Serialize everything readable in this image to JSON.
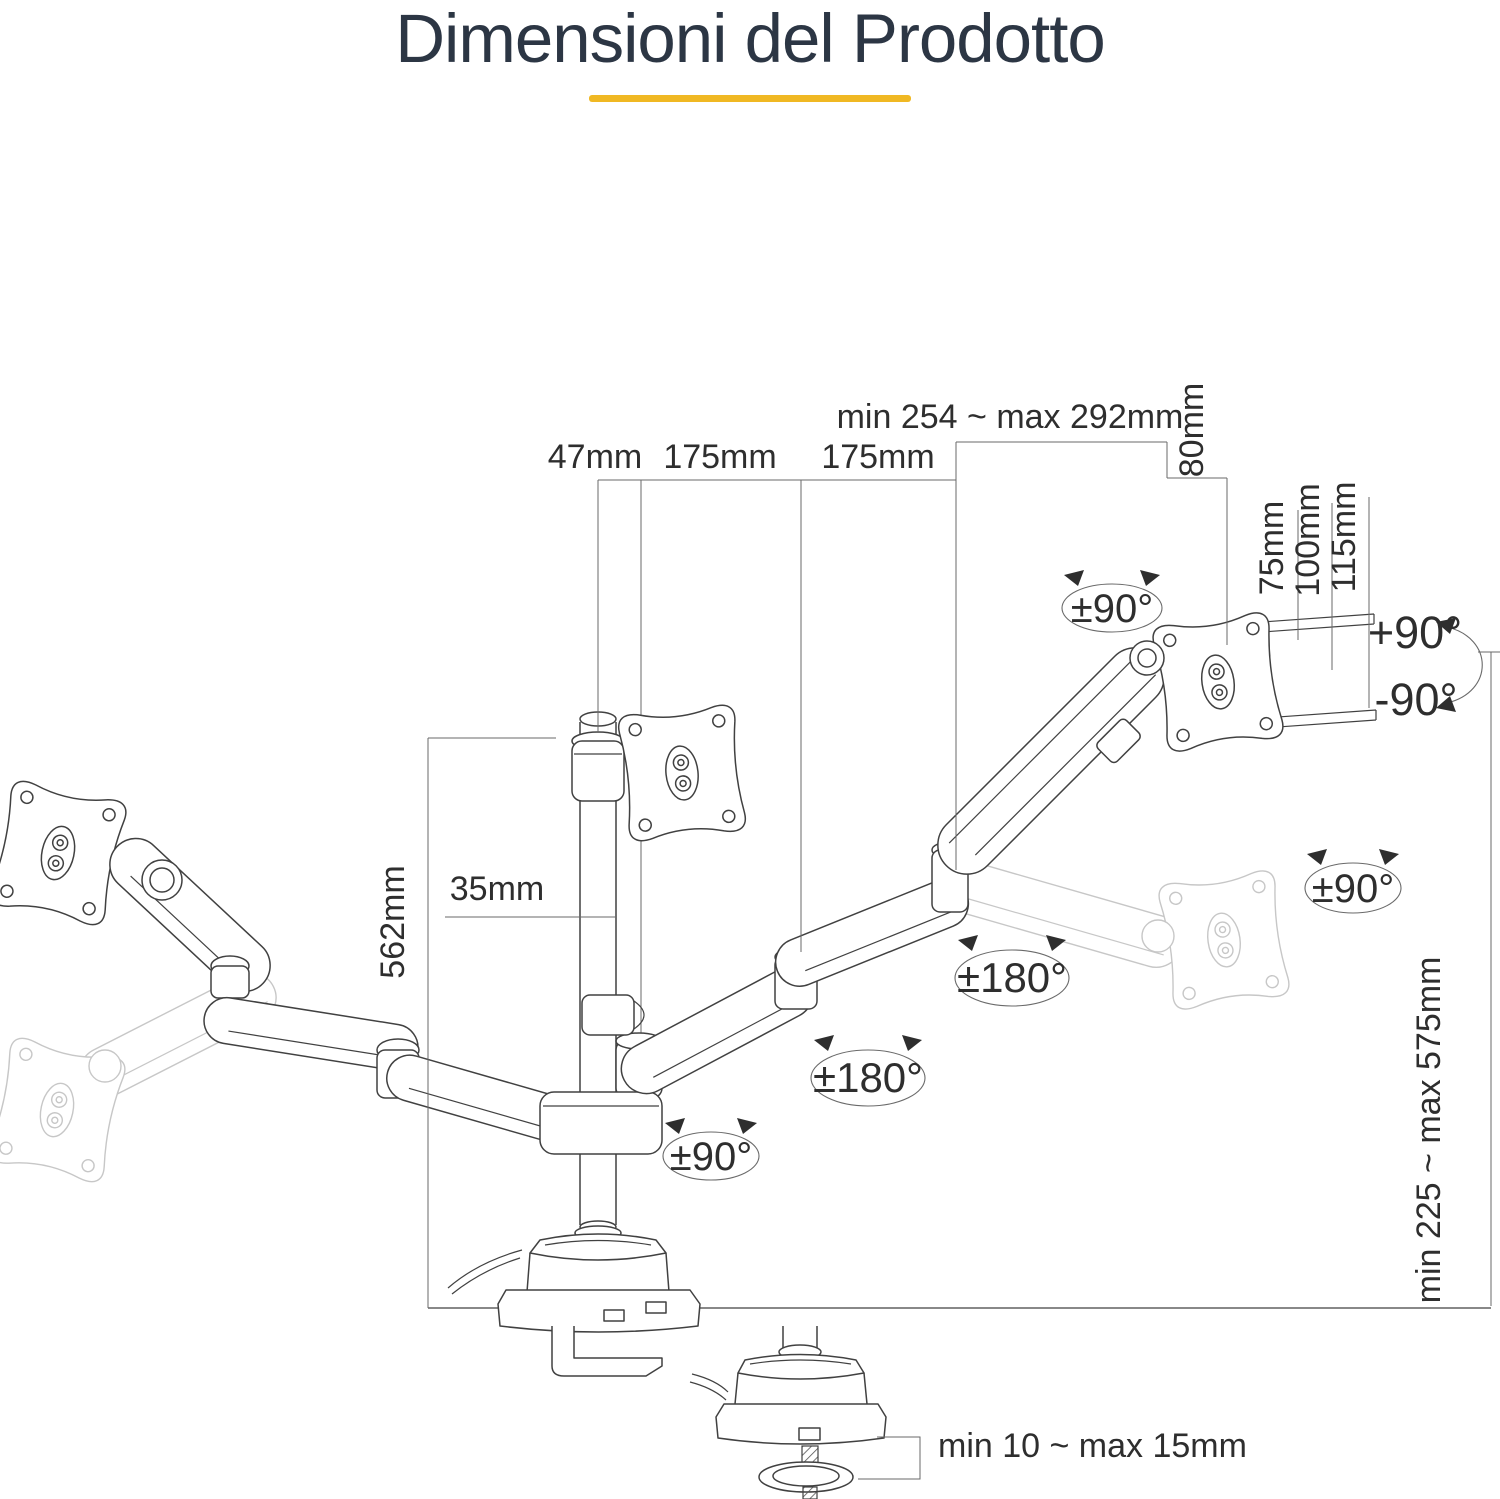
{
  "title": {
    "text": "Dimensioni del Prodotto"
  },
  "theme": {
    "title_color": "#2c3644",
    "underline_color": "#f0b823",
    "line_color": "#414141",
    "dim_color": "#6a6a6a",
    "ghost_color": "#c7c7c7",
    "text_color": "#2e2e2e"
  },
  "diagram": {
    "labels": {
      "top_span": "min 254 ~ max 292mm",
      "offset_47": "47mm",
      "arm1_175": "175mm",
      "arm2_175": "175mm",
      "depth_80": "80mm",
      "vesa_75": "75mm",
      "vesa_100": "100mm",
      "vesa_115": "115mm",
      "swivel_top": "±90°",
      "tilt_up": "+90°",
      "tilt_down": "-90°",
      "pole_width_35": "35mm",
      "pole_height_562": "562mm",
      "rotate_right": "±90°",
      "swivel_arm_outer": "±180°",
      "swivel_arm_inner": "±180°",
      "swivel_base": "±90°",
      "height_range": "min 225 ~ max 575mm",
      "clamp_range": "min 10 ~ max 15mm"
    }
  }
}
